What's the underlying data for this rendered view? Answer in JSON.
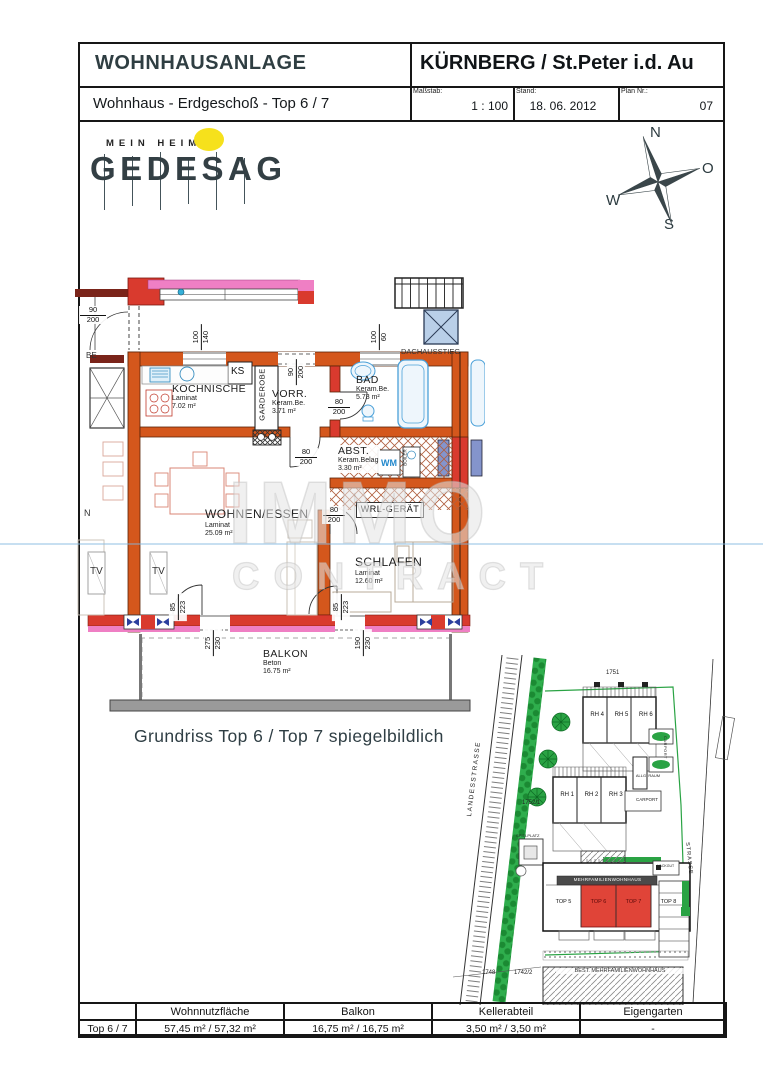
{
  "header": {
    "project": "WOHNHAUSANLAGE",
    "location": "KÜRNBERG / St.Peter i.d. Au",
    "plan_title": "Wohnhaus - Erdgeschoß - Top 6 / 7",
    "scale_label": "Maßstab:",
    "scale_value": "1 : 100",
    "date_label": "Stand:",
    "date_value": "18. 06. 2012",
    "plan_label": "Plan Nr.:",
    "plan_value": "07"
  },
  "logo": {
    "tagline": "MEIN HEIM",
    "name": "GEDESAG"
  },
  "compass": {
    "n": "N",
    "e": "O",
    "s": "S",
    "w": "W"
  },
  "floorplan": {
    "rooms": [
      {
        "name": "KOCHNISCHE",
        "floor": "Laminat",
        "area": "7.02 m²"
      },
      {
        "name": "VORR.",
        "floor": "Keram.Be.",
        "area": "3.71 m²"
      },
      {
        "name": "BAD",
        "floor": "Keram.Be.",
        "area": "5.73 m²"
      },
      {
        "name": "ABST.",
        "floor": "Keram.Belag",
        "area": "3.30 m²"
      },
      {
        "name": "WOHNEN/ESSEN",
        "floor": "Laminat",
        "area": "25.09 m²"
      },
      {
        "name": "SCHLAFEN",
        "floor": "Laminat",
        "area": "12.60 m²"
      },
      {
        "name": "BALKON",
        "floor": "Beton",
        "area": "16.75 m²"
      }
    ],
    "labels": {
      "ks": "KS",
      "garderobe": "GARDEROBE",
      "wm": "WM",
      "boiler": "BOILER",
      "wrl": "WRL-GERÄT",
      "tv": "TV",
      "dach": "DACHAUSSTIEG",
      "be": "BE",
      "n": "N"
    },
    "dims": {
      "entry": [
        "90",
        "200"
      ],
      "win_kueche": [
        "100",
        "140"
      ],
      "tuer_top": [
        "90",
        "200"
      ],
      "win_bad": [
        "100",
        "60"
      ],
      "tuer_bad": [
        "80",
        "200"
      ],
      "tuer_abst": [
        "80",
        "200"
      ],
      "tuer_schlafen": [
        "80",
        "200"
      ],
      "tuer_balkon_links": [
        "85",
        "223"
      ],
      "tuer_balkon_rechts": [
        "85",
        "223"
      ],
      "fenster_balkon_links": [
        "275",
        "230"
      ],
      "fenster_balkon_rechts": [
        "190",
        "230"
      ]
    }
  },
  "caption": "Grundriss Top 6 / Top 7 spiegelbildlich",
  "watermark": {
    "line1": "IMMO",
    "line2": "CONTRACT"
  },
  "siteplan": {
    "street": "LANDESSTRASSE",
    "street2": "STRASSE",
    "rh_top": [
      "RH 4",
      "RH 5",
      "RH 6"
    ],
    "rh_mid": [
      "RH 1",
      "RH 2",
      "RH 3"
    ],
    "tops": [
      "TOP 5",
      "TOP 6",
      "TOP 7",
      "TOP 8"
    ],
    "building": "MEHRFAMILIENWOHNHAUS",
    "existing": "BEST. MEHRFAMILIENWOHNHAUS",
    "carport": "CARPORT",
    "allg_raum": "ALLG. RAUM",
    "spielplatz": "SPIELPLATZ",
    "hackgut": "HACKGUT",
    "parcels": [
      "1751",
      "1752/1",
      "1748",
      "1742/2"
    ]
  },
  "footer": {
    "row_label": "Top 6 / 7",
    "headers": [
      "Wohnnutzfläche",
      "Balkon",
      "Kellerabteil",
      "Eigengarten"
    ],
    "values": [
      "57,45 m² / 57,32 m²",
      "16,75 m² / 16,75 m²",
      "3,50 m² / 3,50 m²",
      "-"
    ]
  }
}
